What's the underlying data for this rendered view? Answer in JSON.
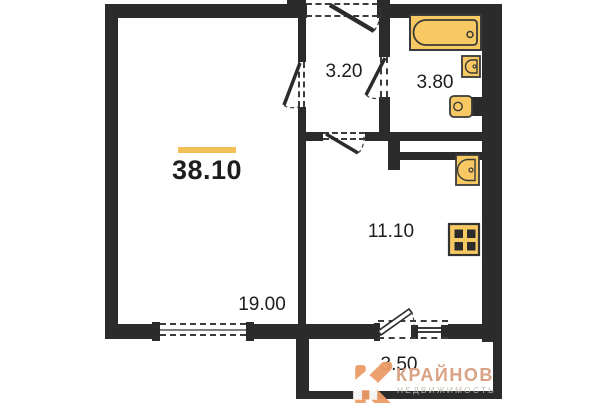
{
  "plan": {
    "areas": {
      "total": "38.10",
      "living_room": "19.00",
      "hallway": "3.20",
      "bathroom": "3.80",
      "kitchen": "11.10",
      "balcony": "3.50"
    },
    "fixtures": [
      "bathtub",
      "sink",
      "toilet",
      "kitchen-sink",
      "stove"
    ],
    "colors": {
      "wall": "#2b2b2b",
      "fixture_fill": "#F8C962",
      "fixture_stroke": "#3a3a3a",
      "accent_bar": "#F2C056"
    }
  },
  "watermark": {
    "mark": "К",
    "brand": "КРАЙНОВ",
    "subtitle": "НЕДВИЖИМОСТЬ",
    "colors": {
      "mark": "#EC9B66",
      "brand": "#D89E7E",
      "subtitle": "#C7BDB3"
    }
  }
}
